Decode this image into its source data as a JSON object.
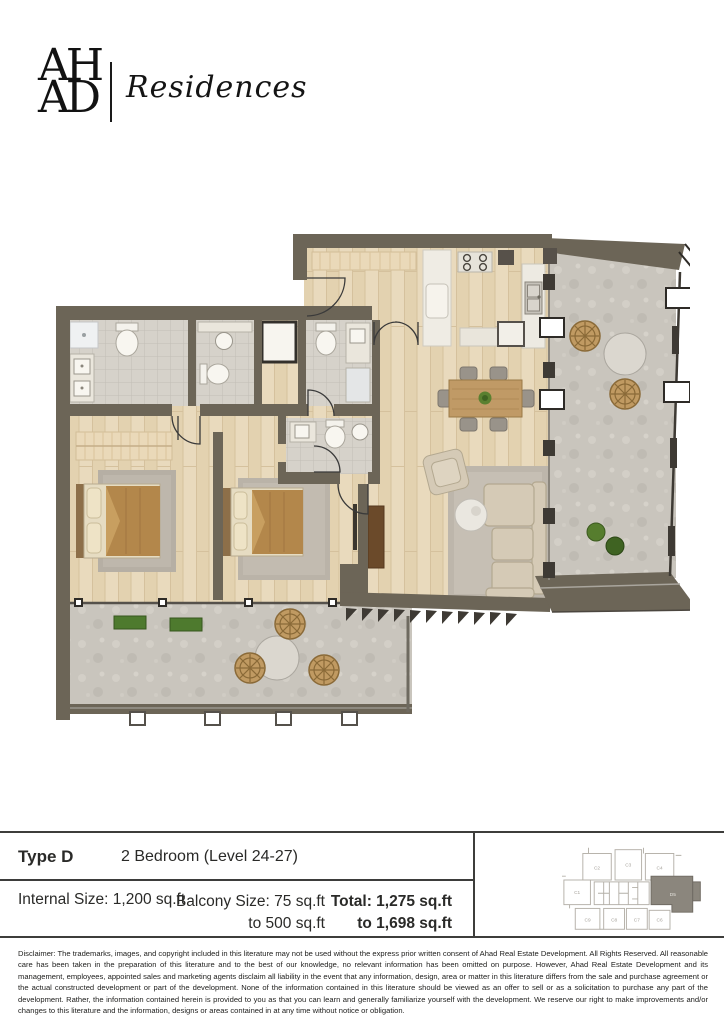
{
  "brand": {
    "monogram_line1": "AH",
    "monogram_line2": "AD",
    "wordmark": "Residences"
  },
  "unit_info": {
    "type_label": "Type D",
    "description": "2 Bedroom (Level 24-27)",
    "internal_size": "Internal Size: 1,200 sq.ft",
    "balcony_size_line1": "Balcony Size: 75 sq.ft",
    "balcony_size_line2": "to 500 sq.ft",
    "total_line1": "Total: 1,275 sq.ft",
    "total_line2": "to 1,698 sq.ft"
  },
  "key_plan": {
    "labels": [
      "C1",
      "C2",
      "C3",
      "C4",
      "C6",
      "C7",
      "C8",
      "C9"
    ],
    "highlighted_label": "D5"
  },
  "disclaimer": "Disclaimer: The trademarks, images, and copyright included in this literature may not be used without the express prior written consent of Ahad Real Estate Development. All Rights Reserved. All reasonable care has been taken in the preparation of this literature and to the best of our knowledge, no relevant information has been omitted on purpose. However, Ahad Real Estate Development and its management, employees, appointed sales and marketing agents disclaim all liability in the event that any information, design, area or matter in this literature differs from the sale and purchase agreement or the actual constructed development or part of the development. None of the information contained in this literature should be viewed as an offer to sell or as a solicitation to purchase any part of the development. Rather, the information contained herein is provided to you as that you can learn and generally familiarize yourself with the development. We reserve our right to make improvements and/or changes to this literature and the information, designs or areas contained in at any time without notice or obligation.",
  "colors": {
    "wall": "#6C6557",
    "wood_floor": "#E8D9BC",
    "tile_floor": "#D6D2CA",
    "concrete": "#C9C5BD",
    "highlight_unit": "#8B867D",
    "bed_blanket": "#B3874B",
    "plant": "#567D2E"
  }
}
